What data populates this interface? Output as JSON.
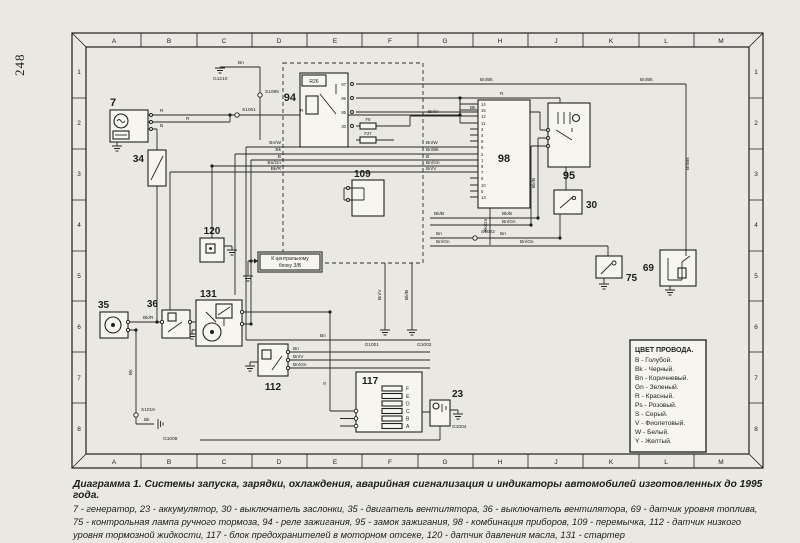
{
  "page": {
    "number": "248"
  },
  "caption": {
    "title": "Диаграмма 1. Системы запуска, зарядки, охлаждения, аварийная сигнализация и индикаторы автомобилей изготовленных до 1995 года.",
    "body": "7 - генератор, 23 - аккумулятор, 30 - выключатель заслонки, 35 - двигатель вентилятора, 36 - выключатель вентилятора, 69 - датчик уровня топлива, 75 - контрольная лампа ручного тормоза, 94 - реле зажигания, 95 - замок зажигания, 98 - комбинация приборов, 109 - перемычка, 112 - датчик низкого уровня тормозной жидкости, 117 - блок предохранителей в моторном отсеке, 120 - датчик давления масла, 131 - стартер"
  },
  "grid": {
    "cols": [
      "A",
      "B",
      "C",
      "D",
      "E",
      "F",
      "G",
      "H",
      "J",
      "K",
      "L",
      "M"
    ],
    "rows": [
      "1",
      "2",
      "3",
      "4",
      "5",
      "6",
      "7",
      "8"
    ]
  },
  "legend": {
    "title": "ЦВЕТ ПРОВОДА.",
    "entries": [
      "B - Голубой.",
      "Bk - Черный.",
      "Bn - Коричневый.",
      "Gn - Зеленый.",
      "R - Красный.",
      "Ps - Розовый.",
      "S - Серый.",
      "V - Фиолетовый.",
      "W - Белый.",
      "Y - Желтый."
    ]
  },
  "components": {
    "generator": "7",
    "battery": "23",
    "flap_switch": "30",
    "resistor": "34",
    "fan_motor": "35",
    "fan_switch": "36",
    "fuel_sensor": "69",
    "handbrake_lamp": "75",
    "ignition_relay": "94",
    "ignition_switch": "95",
    "cluster": "98",
    "jumper": "109",
    "brake_fluid_sensor": "112",
    "fusebox": "117",
    "oil_sensor": "120",
    "starter": "131"
  },
  "relay": {
    "name": "R26",
    "pins": [
      "87",
      "86",
      "85",
      "30"
    ]
  },
  "fuses": {
    "f8": "F8",
    "f27": "F27"
  },
  "fusebox": {
    "letters": [
      "F",
      "E",
      "D",
      "C",
      "B",
      "A"
    ]
  },
  "cluster": {
    "pins": [
      "14",
      "15",
      "12",
      "11",
      "3",
      "4",
      "8",
      "9",
      "2",
      "1",
      "9",
      "7",
      "6",
      "10",
      "5",
      "13"
    ]
  },
  "connectors": {
    "s1061": "S1061",
    "s1085": "S1085",
    "s1022": "S1022",
    "s1016": "S1016"
  },
  "grounds": {
    "g1210": "G1210",
    "g1008": "G1008",
    "g1001": "G1001",
    "g1002": "G1002",
    "g1004": "G1004"
  },
  "note": {
    "line1": "К центральному",
    "line2": "блоку З/В"
  },
  "wires": {
    "b": "B",
    "bk": "Bk",
    "bn": "Bn",
    "r": "R",
    "bnw": "Bn/W",
    "bnbk": "Bn/Bk",
    "bngn": "Bn/Gn",
    "bnv": "Bn/V",
    "bkr": "Bk/R",
    "bkb": "Bk/B",
    "bkgn": "Bk/Gn",
    "s": "S"
  }
}
